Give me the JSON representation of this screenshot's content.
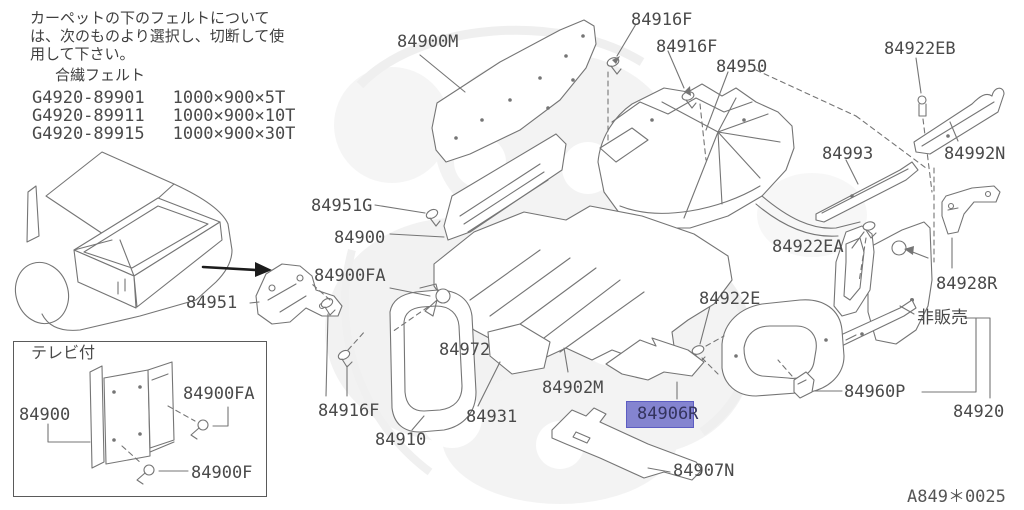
{
  "meta": {
    "background": "#ffffff",
    "line_color": "#757575",
    "text_color": "#4a4a4a",
    "highlight_fill": "#8484d0",
    "highlight_border": "#5c5cc2"
  },
  "note": {
    "lines": [
      "カーペットの下のフェルトについて",
      "は、次のものより選択し、切断して使",
      "用して下さい。"
    ],
    "felt_title": "合繊フェルト",
    "felt_rows": [
      {
        "code": "G4920-89901",
        "size": "1000×900×5T"
      },
      {
        "code": "G4920-89911",
        "size": "1000×900×10T"
      },
      {
        "code": "G4920-89915",
        "size": "1000×900×30T"
      }
    ]
  },
  "inset": {
    "title": "テレビ付",
    "bracket_label": "84900",
    "clip_top_label": "84900FA",
    "clip_bottom_label": "84900F"
  },
  "parts": {
    "p84900M": "84900M",
    "p84916F": "84916F",
    "p84950": "84950",
    "p84922EB": "84922EB",
    "p84993": "84993",
    "p84992N": "84992N",
    "p84951G": "84951G",
    "p84900": "84900",
    "p84922EA": "84922EA",
    "p84900FA": "84900FA",
    "p84928R": "84928R",
    "p84951": "84951",
    "p84922E": "84922E",
    "not_sold": "非販売",
    "p84972": "84972",
    "p84902M": "84902M",
    "p84931": "84931",
    "p84906R": "84906R",
    "p84910": "84910",
    "p84960P": "84960P",
    "p84920": "84920",
    "p84907N": "84907N"
  },
  "footer": {
    "code": "A849＊0025"
  }
}
